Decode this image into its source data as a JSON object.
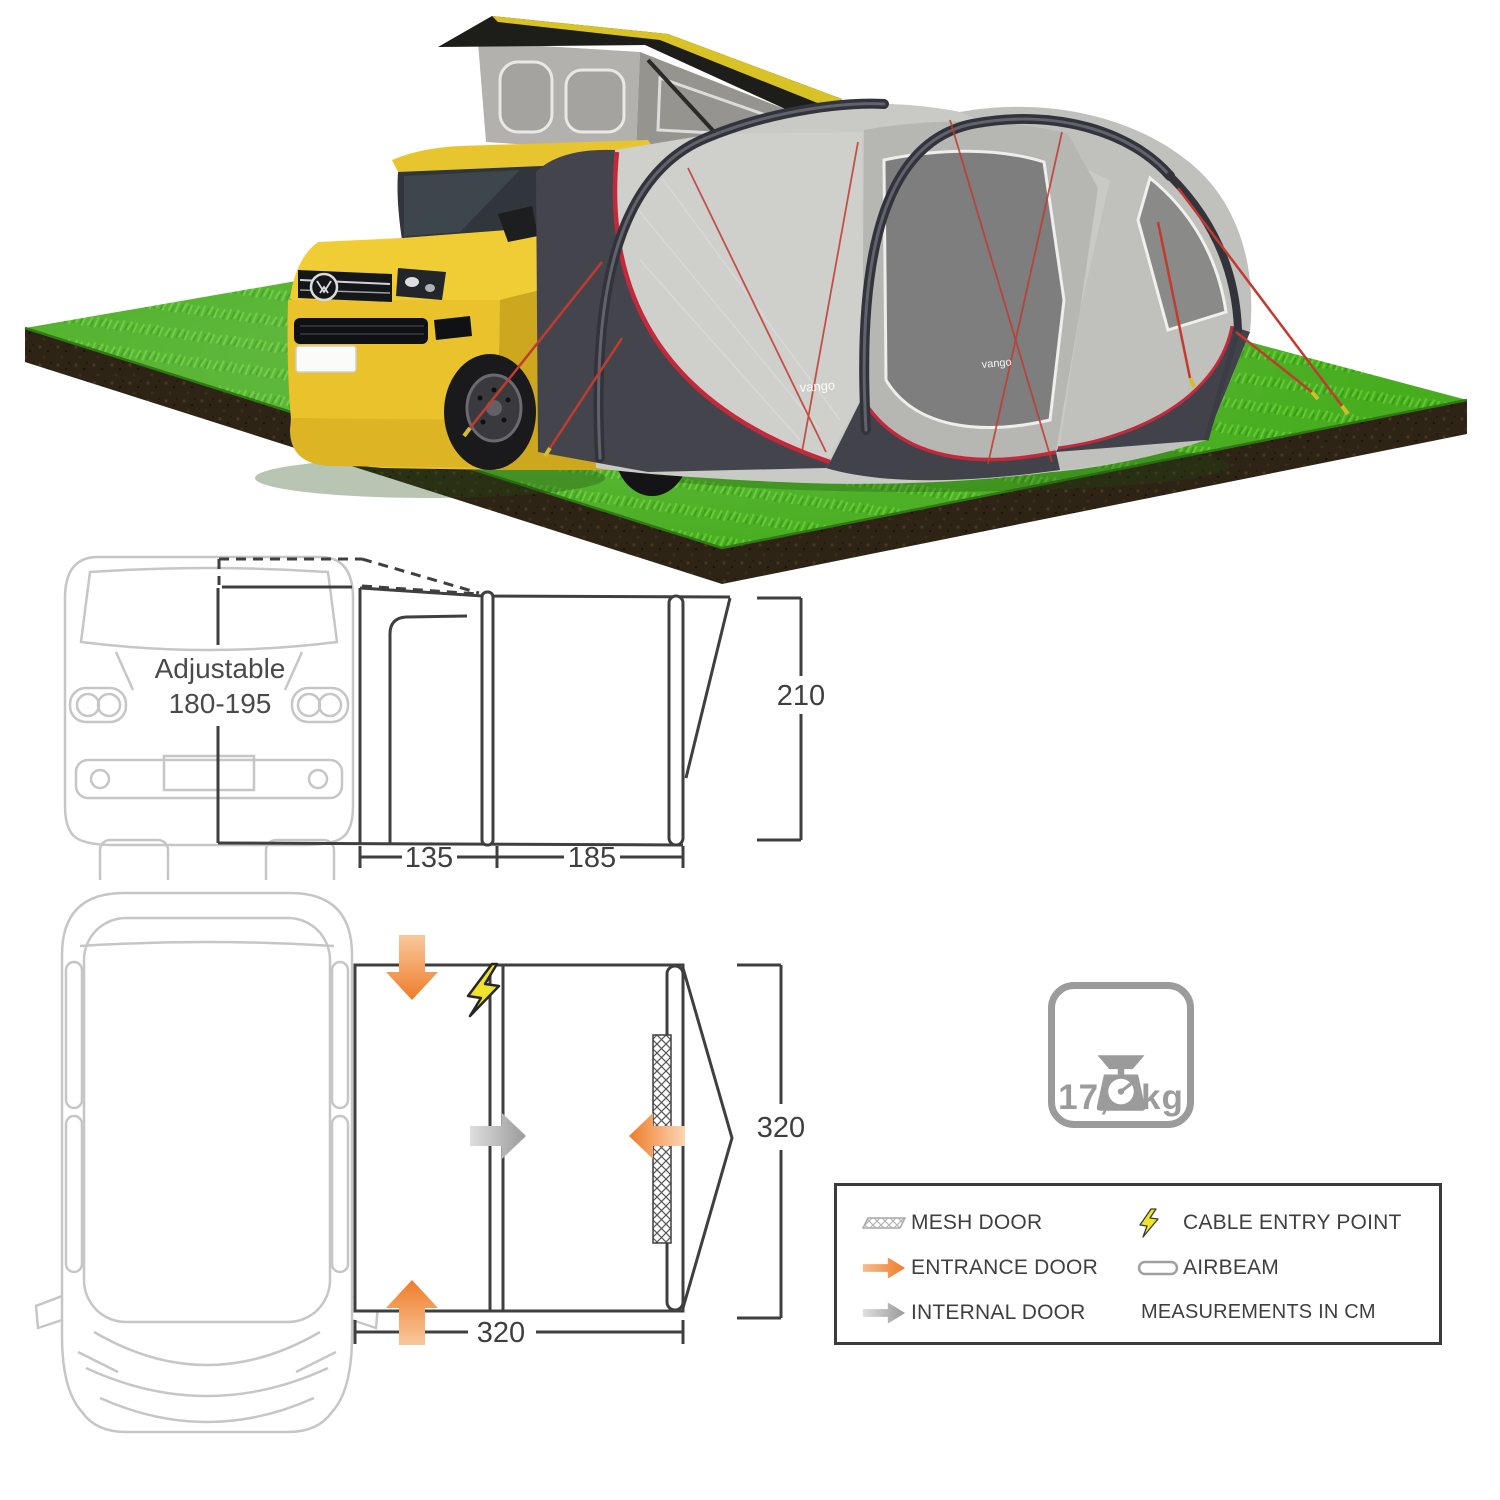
{
  "hero": {
    "brand": "vango",
    "description_icons": {
      "campervan": "yellow-vw-campervan-with-raised-pop-top",
      "awning": "grey-driveaway-awning-tent",
      "ground": "green-grass-platform-with-soil-edge"
    }
  },
  "side_diagram": {
    "adjustable_line1": "Adjustable",
    "adjustable_line2": "180-195",
    "dim_left": "135",
    "dim_right": "185",
    "dim_height": "210"
  },
  "floor_diagram": {
    "dim_width": "320",
    "dim_depth": "320",
    "icons": {
      "entrance_top": "orange-arrow-down",
      "entrance_bottom": "orange-arrow-up",
      "entrance_mesh": "orange-arrow-left",
      "internal_door": "grey-arrow-right",
      "cable_entry": "yellow-lightning-bolt",
      "mesh_door": "crosshatch-strip"
    }
  },
  "weight": {
    "label": "17,6 kg",
    "icon": "kitchen-scale-icon"
  },
  "legend": {
    "mesh": "MESH DOOR",
    "entrance": "ENTRANCE DOOR",
    "internal": "INTERNAL DOOR",
    "cable": "CABLE ENTRY POINT",
    "airbeam": "AIRBEAM",
    "note": "MEASUREMENTS IN CM"
  },
  "colors": {
    "accent_orange": "#EE7D2C",
    "accent_red": "#C4293B",
    "grass_green": "#47AD1F",
    "soil_brown": "#2E2416",
    "van_yellow": "#E9C22C",
    "tent_charcoal": "#44444D",
    "tent_grey": "#C9C9C6",
    "diagram_dark": "#3F3F3F",
    "diagram_light": "#C6C6C6",
    "icon_grey": "#9B9B9B",
    "lightning_yellow": "#EFE32B"
  }
}
